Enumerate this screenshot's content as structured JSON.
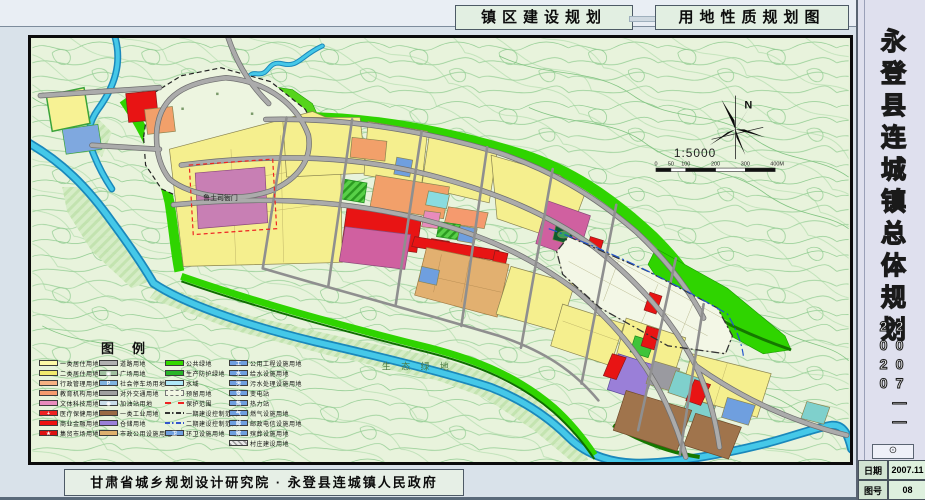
{
  "header": {
    "plan_label": "镇区建设规划",
    "map_label": "用地性质规划图"
  },
  "sidebar": {
    "title": "永登县连城镇总体规划",
    "period": "2007——2020",
    "seal": "⊙",
    "info": [
      {
        "label": "日期",
        "value": "2007.11"
      },
      {
        "label": "图号",
        "value": "08"
      }
    ]
  },
  "footer": {
    "credit": "甘肃省城乡规划设计研究院 · 永登县连城镇人民政府"
  },
  "map": {
    "north_label": "N",
    "scale_text": "1:5000",
    "scalebar_labels": [
      "0",
      "50",
      "100",
      "200",
      "300",
      "400M"
    ],
    "annotations": {
      "landmark": "鲁土司衙门",
      "eco": "生 态 绿 地"
    }
  },
  "legend": {
    "title": "图例",
    "columns": [
      {
        "items": [
          {
            "label": "一类居住用地",
            "color": "#fdf9a8"
          },
          {
            "label": "二类居住用地",
            "color": "#f2ea6e"
          },
          {
            "label": "行政管理用地",
            "color": "#f5b183"
          },
          {
            "label": "教育机构用地",
            "color": "#f59a6e"
          },
          {
            "label": "文体科技用地",
            "color": "#e88bbd"
          },
          {
            "label": "医疗保健用地",
            "color": "#ee2222",
            "glyph": "+"
          },
          {
            "label": "商业金融用地",
            "color": "#ee1111"
          },
          {
            "label": "集贸市场用地",
            "color": "#dd1111",
            "glyph": "★"
          }
        ]
      },
      {
        "items": [
          {
            "label": "道路用地",
            "color": "#b0b0b0"
          },
          {
            "label": "广场用地",
            "color": "#9fbf9f",
            "glyph": "▣"
          },
          {
            "label": "社会停车场用地",
            "color": "#7fb3df",
            "glyph": "P"
          },
          {
            "label": "对外交通用地",
            "color": "#a0a0a0"
          },
          {
            "label": "加油站用地",
            "color": "#c8dce8",
            "glyph": "◉"
          },
          {
            "label": "一类工业用地",
            "color": "#9a6a45"
          },
          {
            "label": "仓储用地",
            "color": "#9a7fd8"
          },
          {
            "label": "市政公用设施用地",
            "color": "#deb06e"
          }
        ]
      },
      {
        "items": [
          {
            "label": "公共绿地",
            "color": "#33d900"
          },
          {
            "label": "生产防护绿地",
            "color": "#28b428"
          },
          {
            "label": "水域",
            "color": "#aee8f8"
          },
          {
            "label": "预留用地",
            "color": "#f2f6e4",
            "type": "dashfill"
          },
          {
            "label": "保护范围",
            "type": "line-dashed",
            "line_color": "#ee2222"
          },
          {
            "label": "一期建设控制范围",
            "type": "line-dashdot",
            "line_color": "#333333"
          },
          {
            "label": "二期建设控制范围",
            "type": "line-dashdot",
            "line_color": "#3355cc"
          },
          {
            "label": "环卫设施用地",
            "color": "#6f9fdf",
            "glyph": "卫"
          }
        ]
      },
      {
        "items": [
          {
            "label": "公用工程设施用地",
            "color": "#6f9fdf",
            "glyph": "工"
          },
          {
            "label": "给水设施用地",
            "color": "#6f9fdf",
            "glyph": "水"
          },
          {
            "label": "污水处理设施用地",
            "color": "#6f9fdf",
            "glyph": "污"
          },
          {
            "label": "变电站",
            "color": "#6f9fdf",
            "glyph": "变"
          },
          {
            "label": "热力站",
            "color": "#6f9fdf",
            "glyph": "热"
          },
          {
            "label": "燃气设施用地",
            "color": "#6f9fdf",
            "glyph": "气"
          },
          {
            "label": "邮政电信设施用地",
            "color": "#6f9fdf",
            "glyph": "邮"
          },
          {
            "label": "殡葬设施用地",
            "color": "#6f9fdf",
            "glyph": "殡"
          },
          {
            "label": "村庄建设用地",
            "color": "#d8d8d8",
            "type": "hatch"
          }
        ]
      }
    ]
  },
  "colors": {
    "residential1": "#fdf9a8",
    "residential2": "#f2ea6e",
    "admin": "#f5b183",
    "culture": "#e88bbd",
    "commercial": "#ee1111",
    "industry": "#9a6a45",
    "warehouse": "#9a7fd8",
    "utility": "#6f9fdf",
    "public_green": "#2fd400",
    "water": "#45c8e8",
    "road": "#ababab",
    "landmark_fill": "#c87fb4"
  }
}
